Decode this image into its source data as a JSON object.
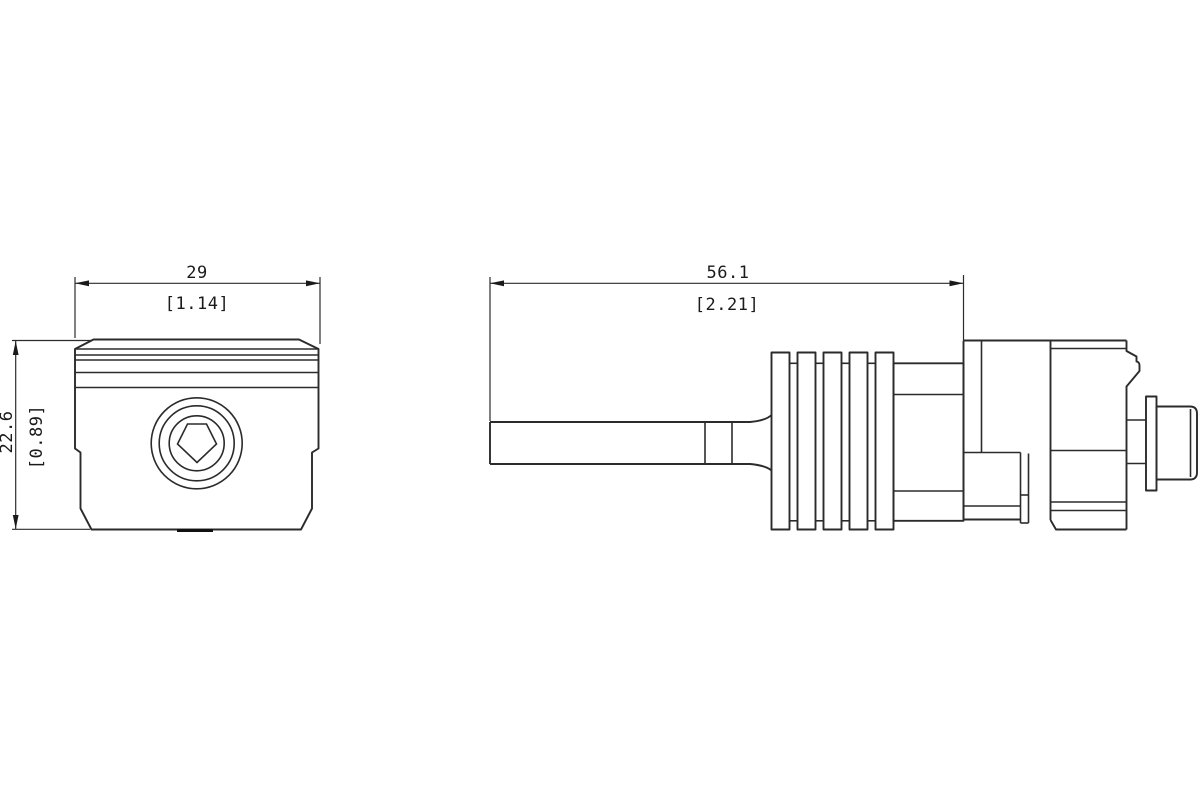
{
  "page": {
    "background": "#ffffff",
    "line_color": "#2b2b2b",
    "text_color": "#1a1a1a",
    "kind": "technical dimension drawing, two orthographic views of a mechanical component"
  },
  "views": {
    "front": {
      "label": "front-view",
      "width_dim": {
        "primary": "29",
        "secondary": "[1.14]"
      },
      "height_dim": {
        "primary": "22.6",
        "secondary": "[0.89]"
      }
    },
    "side": {
      "label": "side-view",
      "length_dim": {
        "primary": "56.1",
        "secondary": "[2.21]"
      }
    }
  }
}
